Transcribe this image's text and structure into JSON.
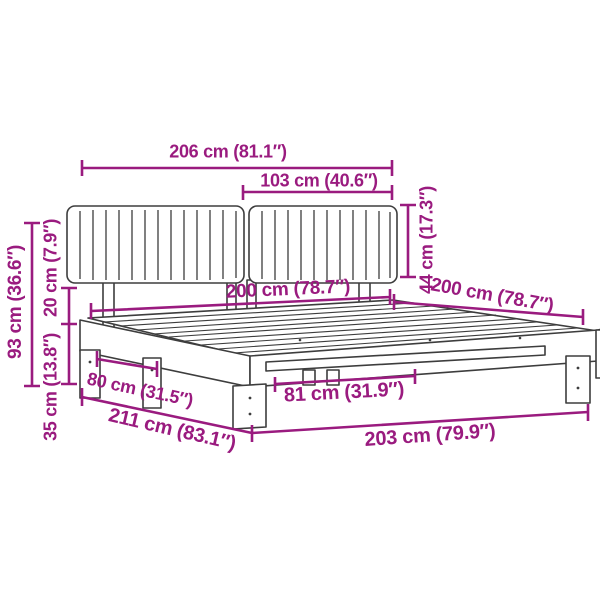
{
  "diagram": {
    "title": "Bed frame with upholstered headboard - dimension diagram",
    "accent_color": "#9A1B7F",
    "outline_color": "#3D3D3D",
    "background_color": "#FFFFFF",
    "unit_system": "cm and inches",
    "dimensions": {
      "total_width": {
        "cm": 206,
        "inch": 81.1,
        "label": "206 cm (81.1″)"
      },
      "headboard_section_width": {
        "cm": 103,
        "inch": 40.6,
        "label": "103 cm (40.6″)"
      },
      "headboard_cushion_height": {
        "cm": 44,
        "inch": 17.3,
        "label": "44 cm (17.3″)"
      },
      "slat_area_width": {
        "cm": 200,
        "inch": 78.7,
        "label": "200 cm (78.7″)"
      },
      "side_rail_length": {
        "cm": 200,
        "inch": 78.7,
        "label": "200 cm (78.7″)"
      },
      "headboard_total_height": {
        "cm": 93,
        "inch": 36.6,
        "label": "93 cm (36.6″)"
      },
      "cushion_to_frame_gap": {
        "cm": 20,
        "inch": 7.9,
        "label": "20 cm (7.9″)"
      },
      "frame_height": {
        "cm": 35,
        "inch": 13.8,
        "label": "35 cm (13.8″)"
      },
      "left_leg_span": {
        "cm": 80,
        "inch": 31.5,
        "label": "80 cm (31.5″)"
      },
      "total_length": {
        "cm": 211,
        "inch": 83.1,
        "label": "211 cm (83.1″)"
      },
      "center_leg_span": {
        "cm": 81,
        "inch": 31.9,
        "label": "81 cm (31.9″)"
      },
      "frame_front_width": {
        "cm": 203,
        "inch": 79.9,
        "label": "203 cm (79.9″)"
      }
    }
  }
}
